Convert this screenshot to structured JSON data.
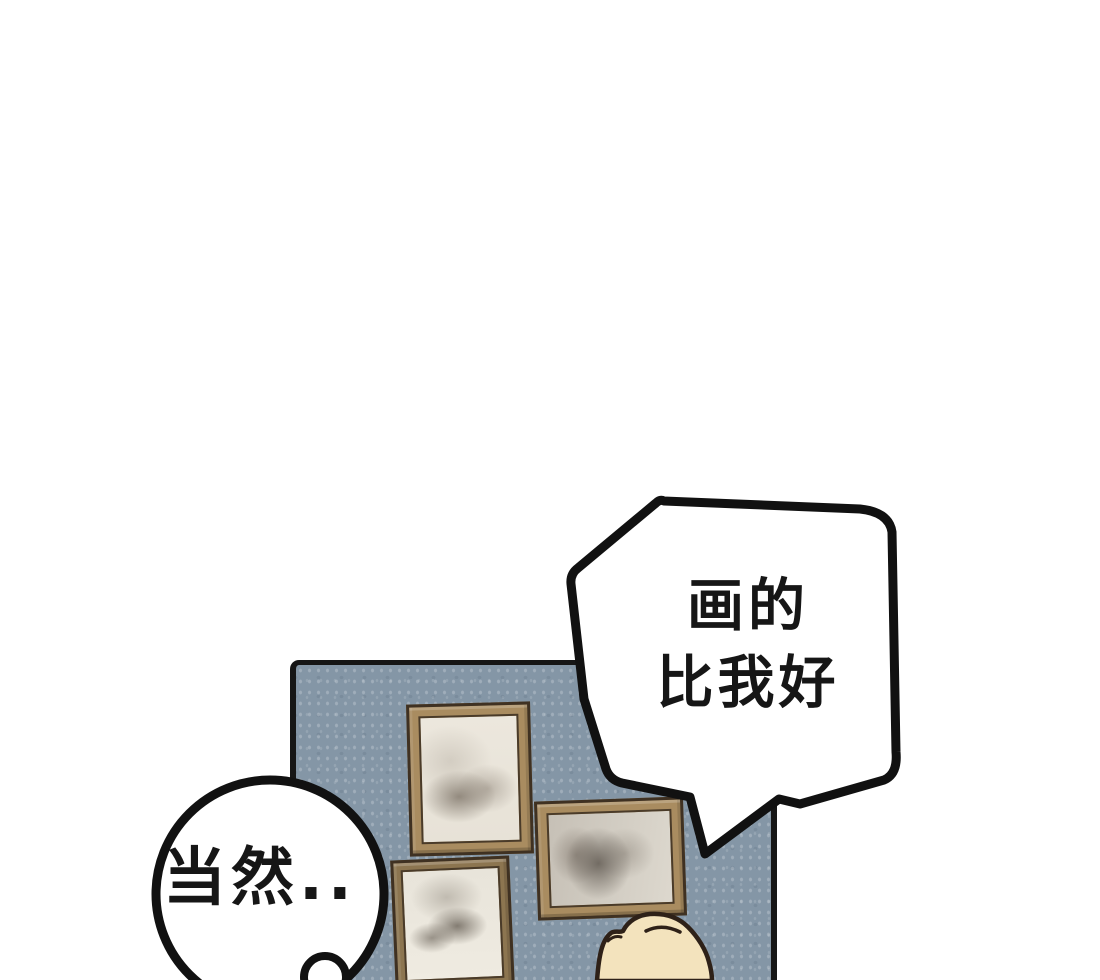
{
  "scene_type": "webtoon-comic-panel",
  "speech_bubbles": {
    "top_right": {
      "shape": "angular-polygon-with-tail-pointing-down-left",
      "lines": [
        "画的",
        "比我好"
      ]
    },
    "bottom_left": {
      "shape": "round-with-small-bump-tail",
      "text": "当然.."
    }
  },
  "scene": {
    "wall": "blue-gray speckled wall panel with black border",
    "picture_frames": [
      "portrait frame top-left",
      "landscape frame right",
      "portrait frame bottom-left"
    ],
    "character": "blond head seen from behind at bottom of wall"
  },
  "colors": {
    "ink": "#111111",
    "paper": "#ffffff",
    "wall": "#8496a6",
    "wall_border": "#161616",
    "wood_light": "#a98c60",
    "wood_dark": "#8c7550",
    "frame_outline": "#3f3122",
    "picture_bg": "#ece7dd",
    "hair": "#f3e3bd",
    "hair_outline": "#2e2118",
    "text": "#161616"
  }
}
